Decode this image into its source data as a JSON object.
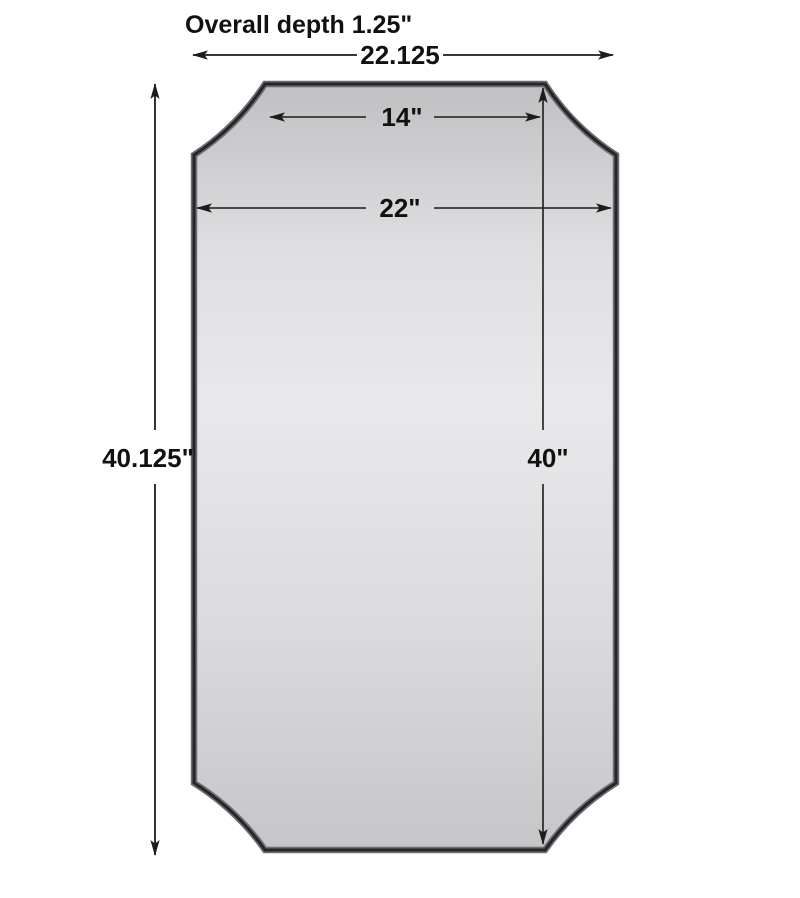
{
  "labels": {
    "overall_depth": "Overall depth 1.25\"",
    "overall_width": "22.125",
    "top_width": "14\"",
    "mirror_width": "22\"",
    "overall_height": "40.125\"",
    "mirror_height": "40\""
  },
  "colors": {
    "background": "#ffffff",
    "line": "#1c1c1c",
    "text": "#111111",
    "frame": "#26262a",
    "frame_bevel": "#6e6e72",
    "surface_top": "#c0c0c2",
    "surface_upper": "#dfdfe1",
    "surface_mid": "#e9e9eb",
    "surface_lower": "#dadadc",
    "surface_bottom": "#c6c6c8"
  }
}
